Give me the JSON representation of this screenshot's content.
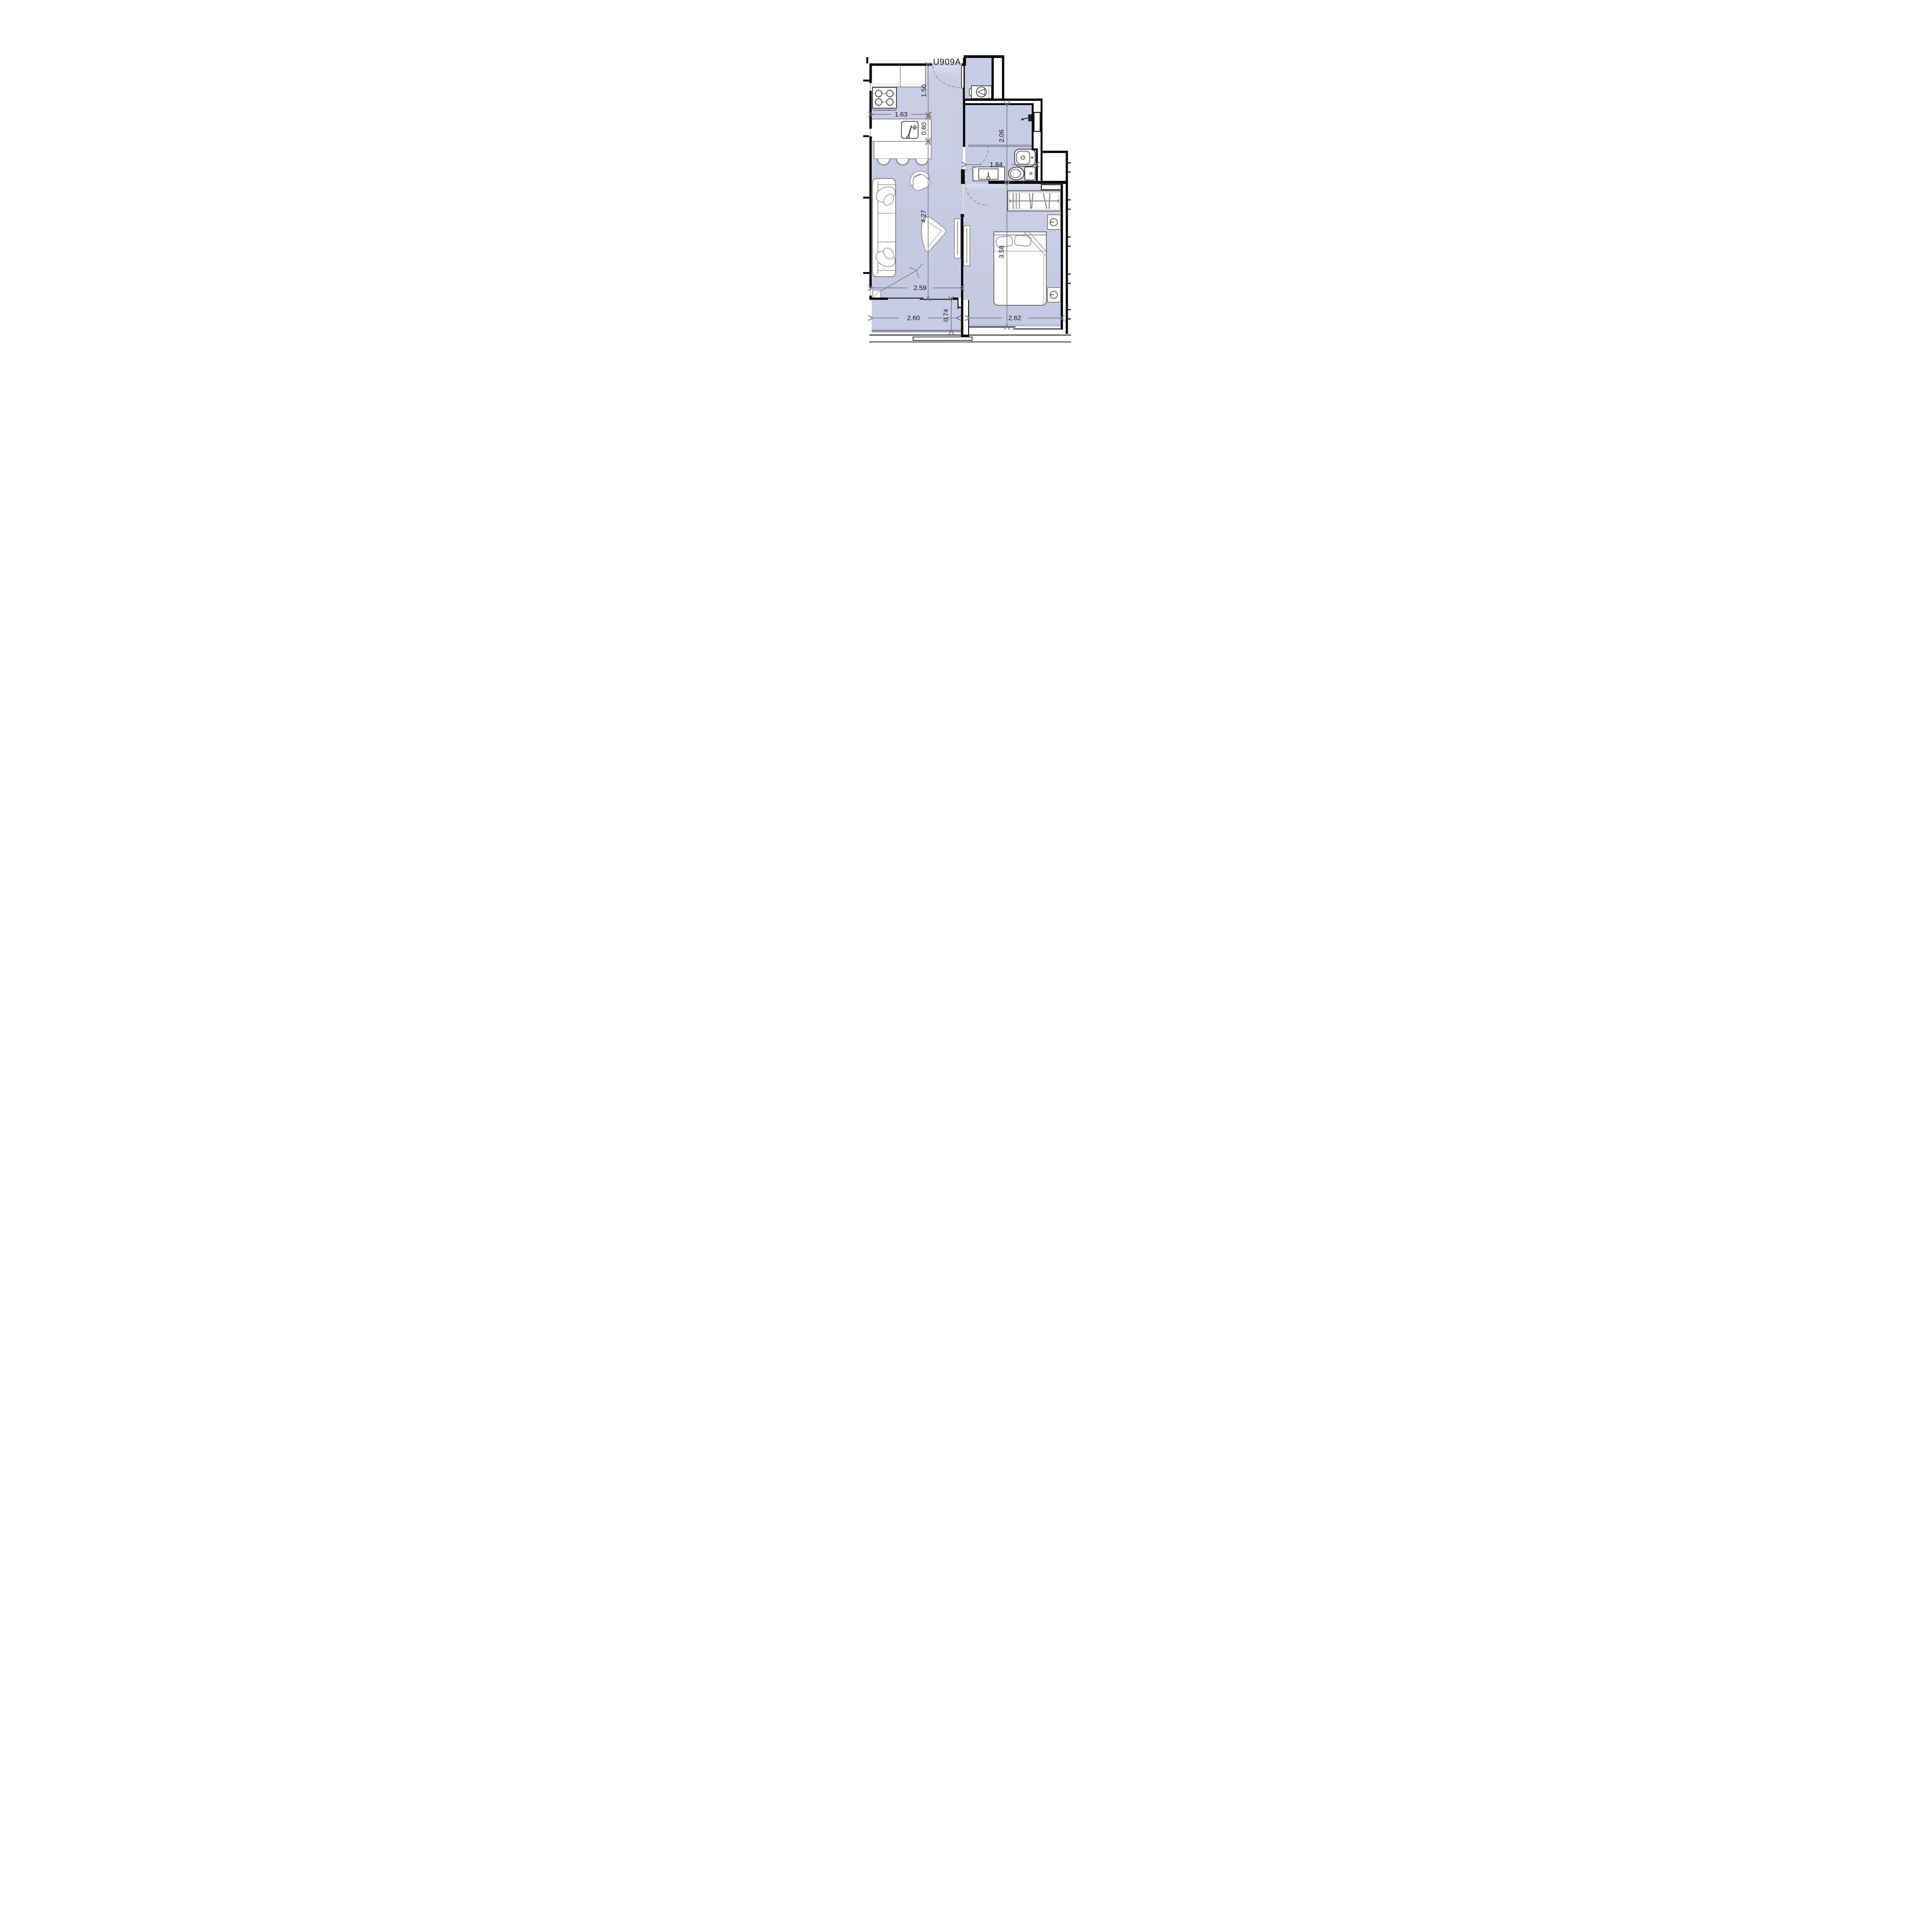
{
  "unit_label": "U909A",
  "dimensions": {
    "entry_depth": "1.50",
    "kitchen_width": "1.63",
    "counter_depth": "0.60",
    "living_length": "4.27",
    "living_width": "2.59",
    "bathroom_length": "2.06",
    "bathroom_width": "1.84",
    "bedroom_length": "3.58",
    "bedroom_width": "2.62",
    "terrace_width": "2.60",
    "terrace_depth": "0.74"
  },
  "colors": {
    "background": "#ffffff",
    "floor": "#c9cae3",
    "wall": "#0d0d0d",
    "dimension_line": "#7a7a7a",
    "text": "#141414",
    "furniture_stroke": "#808080"
  },
  "icon_names": [
    "stove-icon",
    "kitchen-sink-icon",
    "bar-stool-icon",
    "washing-machine-icon",
    "shower-head-icon",
    "bidet-icon",
    "toilet-icon",
    "washbasin-icon",
    "wardrobe-icon",
    "bed-icon",
    "lamp-icon",
    "nightstand-icon",
    "sofa-icon",
    "armchair-icon",
    "coffee-table-icon",
    "floor-lamp-icon",
    "door-swing-arc",
    "sliding-door",
    "window",
    "wall-niche",
    "duct-shaft"
  ]
}
